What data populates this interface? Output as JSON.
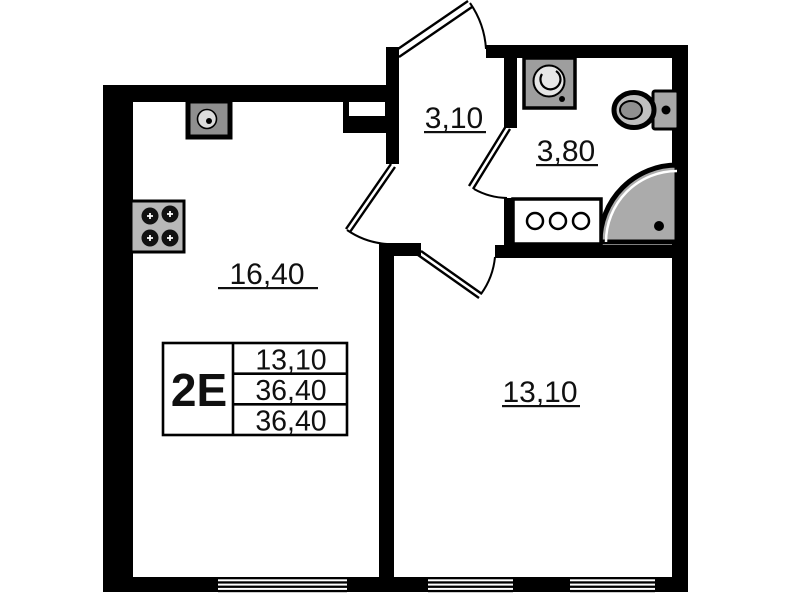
{
  "plan_title": "apartment-floor-plan",
  "unit": {
    "type_label": "2E",
    "stats": [
      "13,10",
      "36,40",
      "36,40"
    ]
  },
  "rooms": [
    {
      "id": "kitchen-living-room",
      "area": "16,40"
    },
    {
      "id": "hallway",
      "area": "3,10"
    },
    {
      "id": "bathroom",
      "area": "3,80"
    },
    {
      "id": "room",
      "area": "13,10"
    }
  ],
  "fixtures": [
    "kitchen-sink",
    "stove",
    "washing-machine",
    "toilet",
    "corner-shower",
    "vanity"
  ],
  "doors": [
    "entry-door",
    "kitchen-door",
    "room-door",
    "bathroom-door"
  ],
  "windows_count": 3,
  "colors": {
    "walls": "#000000",
    "background": "#ffffff",
    "fixture_gray": "#b0b0b0",
    "shower_gray": "#ababab"
  }
}
